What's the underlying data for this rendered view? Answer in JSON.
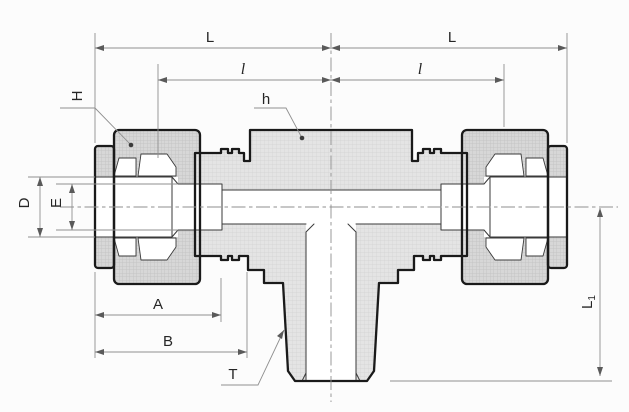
{
  "drawing": {
    "type": "engineering-cross-section-male-branch-tee-tube-fitting",
    "dimension_labels": {
      "L_left": "L",
      "L_right": "L",
      "l_left": "l",
      "l_right": "l",
      "H": "H",
      "h": "h",
      "D": "D",
      "E": "E",
      "A": "A",
      "B": "B",
      "T": "T",
      "L1_main": "L",
      "L1_sub": "1"
    }
  },
  "colors": {
    "background": "#fcfcfc",
    "outline": "#1a1a1a",
    "thin": "#3a3a3a",
    "dim": "#8f8f8f",
    "arrow": "#5a5a5a",
    "text": "#262626",
    "body_fill": "#e4e4e4",
    "body_grid": "#d2d2d2",
    "nut_fill": "#d7d7d7",
    "nut_grid": "#bfbfbf",
    "white": "#ffffff"
  }
}
